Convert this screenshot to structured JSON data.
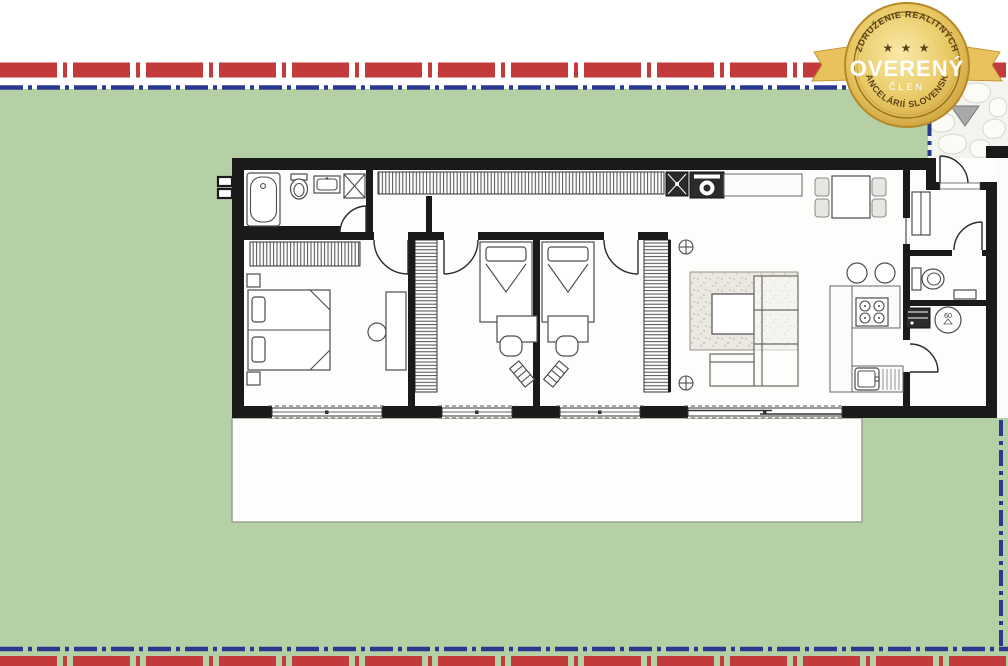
{
  "badge": {
    "arc_top": "ZDRUŽENIE REALITNÝCH",
    "arc_bottom": "KANCELÁRIÍ SLOVENSKA",
    "stars": "★ ★ ★",
    "title": "OVERENÝ",
    "member": "ČLEN"
  },
  "floorplan": {
    "boiler_label": "60",
    "rooms": [
      "bathroom",
      "hallway",
      "master-bedroom",
      "bedroom-2",
      "bedroom-3",
      "living-room",
      "kitchen",
      "dining-area",
      "entry-hall",
      "wc",
      "utility-room",
      "terrace",
      "garden-plot"
    ],
    "furniture_icons": [
      "bathtub-icon",
      "toilet-icon",
      "washbasin-icon",
      "shower-icon",
      "wardrobe-icon",
      "washing-machine-icon",
      "dryer-icon",
      "double-bed-icon",
      "nightstand-icon",
      "single-bed-icon",
      "desk-icon",
      "chair-icon",
      "dressing-table-icon",
      "stool-icon",
      "dining-table-icon",
      "dining-chair-icon",
      "sofa-icon",
      "rug-icon",
      "coffee-table-icon",
      "cooktop-icon",
      "oven-icon",
      "kitchen-sink-icon",
      "bar-stool-icon",
      "boiler-icon",
      "pipe-icon",
      "cabinet-icon",
      "entrance-marker-icon",
      "window-icon",
      "sliding-door-icon"
    ]
  },
  "colors": {
    "plot_green": "#b6d0a6",
    "boundary_red": "#c23a3a",
    "boundary_blue": "#2b3890",
    "badge_gold": "#e7c469",
    "badge_text_dark": "#5a431a",
    "badge_text_light": "#ffffff",
    "wall": "#1a1a1a"
  }
}
